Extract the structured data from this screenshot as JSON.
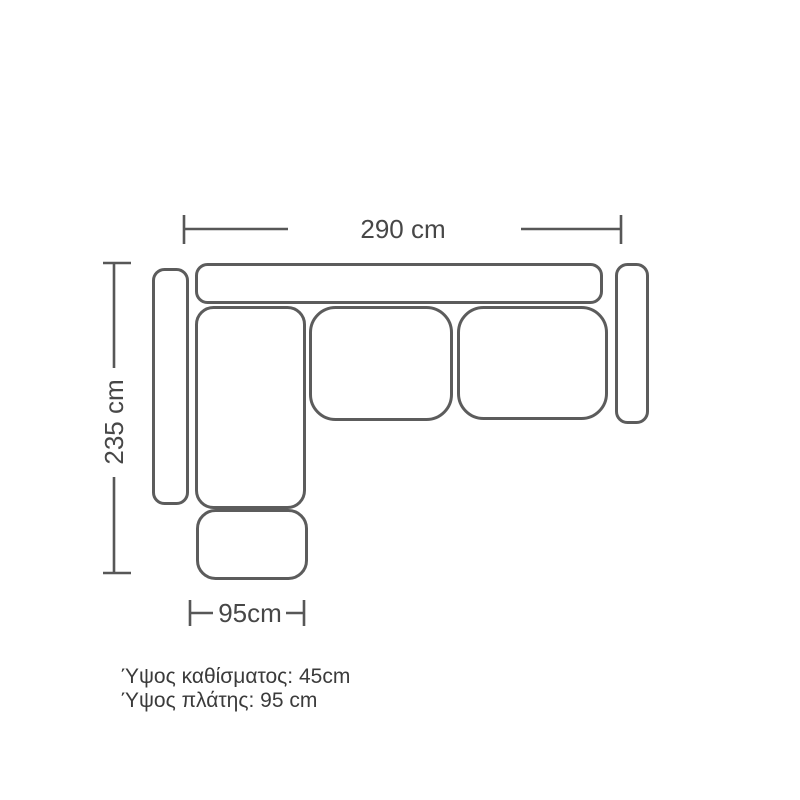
{
  "diagram": {
    "dimensions": {
      "total_width": "290 cm",
      "total_depth": "235 cm",
      "chaise_width": "95cm"
    },
    "notes": {
      "seat_height": "Ύψος καθίσματος: 45cm",
      "back_height": "Ύψος πλάτης: 95 cm"
    },
    "colors": {
      "outline": "#5c5c5c",
      "dimension_line": "#575757",
      "dimension_text": "#474747",
      "note_text": "#3b3b3b",
      "background": "#ffffff"
    }
  }
}
